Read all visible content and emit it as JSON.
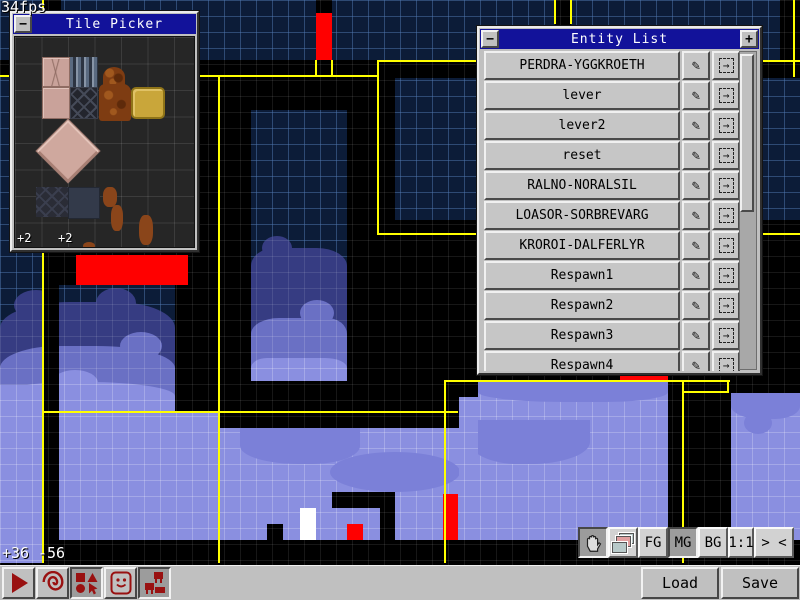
{
  "hud": {
    "fps": "34fps",
    "coord_x": "+36",
    "coord_y": "-56"
  },
  "colors": {
    "titlebar": "#12129a",
    "navy": "#0c1c38",
    "purple": "#8a8fe0",
    "red": "#ff0000",
    "yellow": "#ffff00",
    "iconred": "#991111",
    "silver": "#c0c0c0"
  },
  "icons": {
    "minimize": "−",
    "add": "+",
    "pencil": "✎",
    "goto": "→",
    "toolbar_tools": [
      "play",
      "spiral",
      "shapes",
      "face",
      "tiles"
    ],
    "layer_tools": [
      "hand",
      "layers"
    ]
  },
  "tile_picker": {
    "title": "Tile Picker",
    "offset_left": "+2",
    "offset_right": "+2",
    "tiles": [
      {
        "x": 27,
        "y": 20,
        "w": 28,
        "h": 30,
        "c": "t-pinkc"
      },
      {
        "x": 55,
        "y": 20,
        "w": 28,
        "h": 30,
        "c": "t-stripe"
      },
      {
        "x": 27,
        "y": 50,
        "w": 28,
        "h": 32,
        "c": "t-pink"
      },
      {
        "x": 55,
        "y": 50,
        "w": 28,
        "h": 32,
        "c": "t-lat"
      },
      {
        "x": 88,
        "y": 30,
        "w": 22,
        "h": 20,
        "c": "t-rock",
        "r": "50% 50% 0 0"
      },
      {
        "x": 84,
        "y": 47,
        "w": 32,
        "h": 37,
        "c": "t-rock"
      },
      {
        "x": 116,
        "y": 50,
        "w": 34,
        "h": 32,
        "c": "t-gold",
        "r": "5px"
      },
      {
        "x": 30,
        "y": 91,
        "w": 46,
        "h": 46,
        "c": "t-diamond",
        "rot": 45
      },
      {
        "x": 21,
        "y": 150,
        "w": 32,
        "h": 30,
        "c": "t-latf"
      },
      {
        "x": 53,
        "y": 150,
        "w": 32,
        "h": 32,
        "c": "t-slab"
      },
      {
        "x": 88,
        "y": 150,
        "w": 14,
        "h": 20,
        "c": "t-rockbit",
        "r": "40%"
      },
      {
        "x": 96,
        "y": 168,
        "w": 12,
        "h": 26,
        "c": "t-rockbit",
        "r": "40%"
      },
      {
        "x": 124,
        "y": 178,
        "w": 14,
        "h": 30,
        "c": "t-rockbit",
        "r": "40%"
      },
      {
        "x": 68,
        "y": 205,
        "w": 12,
        "h": 8,
        "c": "t-rockbit",
        "r": "50%"
      }
    ]
  },
  "entity_list": {
    "title": "Entity List",
    "entities": [
      "PERDRA-YGGKROETH",
      "lever",
      "lever2",
      "reset",
      "RALNO-NORALSIL",
      "LOASOR-SORBREVARG",
      "KROROI-DALFERLYR",
      "Respawn1",
      "Respawn2",
      "Respawn3",
      "Respawn4"
    ]
  },
  "layer_bar": {
    "fg": "FG",
    "mg": "MG",
    "bg": "BG",
    "zoom": "1:1",
    "shrink": "> <"
  },
  "toolbar": {
    "load_label": "Load",
    "save_label": "Save"
  },
  "canvas": {
    "rects": [
      {
        "x": 0,
        "y": 0,
        "w": 800,
        "h": 60,
        "c": "navy"
      },
      {
        "x": 43,
        "y": 0,
        "w": 18,
        "h": 11,
        "c": "black"
      },
      {
        "x": 555,
        "y": 0,
        "w": 16,
        "h": 60,
        "c": "black"
      },
      {
        "x": 780,
        "y": 0,
        "w": 20,
        "h": 77,
        "c": "black"
      },
      {
        "x": 316,
        "y": 0,
        "w": 16,
        "h": 13,
        "c": "black"
      },
      {
        "x": 316,
        "y": 13,
        "w": 16,
        "h": 47,
        "c": "red"
      },
      {
        "x": 0,
        "y": 60,
        "w": 800,
        "h": 17,
        "c": "black"
      },
      {
        "x": 175,
        "y": 77,
        "w": 625,
        "h": 336,
        "c": "black"
      },
      {
        "x": 0,
        "y": 77,
        "w": 175,
        "h": 175,
        "c": "navy"
      },
      {
        "x": 395,
        "y": 78,
        "w": 405,
        "h": 142,
        "c": "navy"
      },
      {
        "x": 251,
        "y": 110,
        "w": 96,
        "h": 271,
        "c": "navy"
      },
      {
        "x": 262,
        "y": 236,
        "w": 30,
        "h": 24,
        "c": "cloudDark",
        "r": "50%"
      },
      {
        "x": 251,
        "y": 248,
        "w": 96,
        "h": 133,
        "c": "cloudDark",
        "r": "24px 30px 0 0/18px"
      },
      {
        "x": 300,
        "y": 300,
        "w": 34,
        "h": 26,
        "c": "cloudMid",
        "r": "50%"
      },
      {
        "x": 251,
        "y": 318,
        "w": 96,
        "h": 63,
        "c": "cloudMid",
        "r": "28px 20px 0 0/16px"
      },
      {
        "x": 251,
        "y": 358,
        "w": 96,
        "h": 23,
        "c": "purple",
        "r": "16px 22px 0 0/10px"
      },
      {
        "x": 44,
        "y": 252,
        "w": 174,
        "h": 33,
        "c": "black"
      },
      {
        "x": 0,
        "y": 252,
        "w": 43,
        "h": 33,
        "c": "navy"
      },
      {
        "x": 76,
        "y": 255,
        "w": 112,
        "h": 30,
        "c": "red"
      },
      {
        "x": 0,
        "y": 285,
        "w": 175,
        "h": 128,
        "c": "navy"
      },
      {
        "x": 175,
        "y": 285,
        "w": 43,
        "h": 128,
        "c": "black"
      },
      {
        "x": 14,
        "y": 290,
        "w": 44,
        "h": 30,
        "c": "cloudDark",
        "r": "50%"
      },
      {
        "x": 96,
        "y": 288,
        "w": 40,
        "h": 30,
        "c": "cloudDark",
        "r": "50%"
      },
      {
        "x": 0,
        "y": 302,
        "w": 175,
        "h": 111,
        "c": "cloudDark",
        "r": "40% 34% 0 0/26px"
      },
      {
        "x": 120,
        "y": 332,
        "w": 42,
        "h": 28,
        "c": "cloudMid",
        "r": "50%"
      },
      {
        "x": 0,
        "y": 346,
        "w": 175,
        "h": 67,
        "c": "cloudMid",
        "r": "34% 45% 0 0/22px"
      },
      {
        "x": 52,
        "y": 370,
        "w": 46,
        "h": 26,
        "c": "purple",
        "r": "50%"
      },
      {
        "x": 0,
        "y": 382,
        "w": 175,
        "h": 31,
        "c": "purple",
        "r": "40% 50% 0 0/14px"
      },
      {
        "x": 0,
        "y": 385,
        "w": 43,
        "h": 178,
        "c": "purple"
      },
      {
        "x": 59,
        "y": 413,
        "w": 741,
        "h": 127,
        "c": "purple"
      },
      {
        "x": 219,
        "y": 413,
        "w": 241,
        "h": 15,
        "c": "black"
      },
      {
        "x": 240,
        "y": 428,
        "w": 120,
        "h": 36,
        "c": "purpleShade",
        "r": "0 0 45% 55%/20px"
      },
      {
        "x": 330,
        "y": 452,
        "w": 130,
        "h": 40,
        "c": "purpleShade",
        "r": "50%"
      },
      {
        "x": 470,
        "y": 420,
        "w": 120,
        "h": 44,
        "c": "purpleShade",
        "r": "0 0 50% 40%/22px"
      },
      {
        "x": 478,
        "y": 382,
        "w": 190,
        "h": 32,
        "c": "purple"
      },
      {
        "x": 478,
        "y": 382,
        "w": 190,
        "h": 20,
        "c": "purpleShade",
        "r": "0 0 40% 55%/12px"
      },
      {
        "x": 459,
        "y": 397,
        "w": 19,
        "h": 143,
        "c": "purple"
      },
      {
        "x": 668,
        "y": 380,
        "w": 63,
        "h": 160,
        "c": "black"
      },
      {
        "x": 620,
        "y": 375,
        "w": 48,
        "h": 6,
        "c": "red"
      },
      {
        "x": 731,
        "y": 393,
        "w": 69,
        "h": 147,
        "c": "purple"
      },
      {
        "x": 731,
        "y": 393,
        "w": 69,
        "h": 26,
        "c": "purpleShade",
        "r": "0 0 45% 55%/16px"
      },
      {
        "x": 744,
        "y": 412,
        "w": 28,
        "h": 22,
        "c": "purpleShade",
        "r": "50%"
      },
      {
        "x": 44,
        "y": 285,
        "w": 15,
        "h": 278,
        "c": "black"
      },
      {
        "x": 332,
        "y": 492,
        "w": 63,
        "h": 16,
        "c": "black"
      },
      {
        "x": 380,
        "y": 508,
        "w": 15,
        "h": 32,
        "c": "black"
      },
      {
        "x": 267,
        "y": 524,
        "w": 16,
        "h": 16,
        "c": "black"
      },
      {
        "x": 300,
        "y": 508,
        "w": 16,
        "h": 32,
        "c": "white"
      },
      {
        "x": 347,
        "y": 524,
        "w": 16,
        "h": 16,
        "c": "red"
      },
      {
        "x": 443,
        "y": 494,
        "w": 15,
        "h": 46,
        "c": "red"
      },
      {
        "x": 44,
        "y": 540,
        "w": 756,
        "h": 23,
        "c": "black"
      },
      {
        "x": 0,
        "y": 540,
        "w": 43,
        "h": 23,
        "c": "purple"
      },
      {
        "x": 0,
        "y": 563,
        "w": 800,
        "h": 2,
        "c": "black"
      },
      {
        "x": 554,
        "y": 0,
        "w": 2,
        "h": 24,
        "c": "yellow"
      },
      {
        "x": 570,
        "y": 0,
        "w": 2,
        "h": 24,
        "c": "yellow"
      },
      {
        "x": 793,
        "y": 0,
        "w": 2,
        "h": 77,
        "c": "yellow"
      },
      {
        "x": 0,
        "y": 75,
        "w": 316,
        "h": 2,
        "c": "yellow"
      },
      {
        "x": 315,
        "y": 60,
        "w": 2,
        "h": 17,
        "c": "yellow"
      },
      {
        "x": 331,
        "y": 60,
        "w": 2,
        "h": 17,
        "c": "yellow"
      },
      {
        "x": 315,
        "y": 75,
        "w": 18,
        "h": 2,
        "c": "yellow"
      },
      {
        "x": 333,
        "y": 75,
        "w": 46,
        "h": 2,
        "c": "yellow"
      },
      {
        "x": 377,
        "y": 60,
        "w": 423,
        "h": 2,
        "c": "yellow"
      },
      {
        "x": 377,
        "y": 60,
        "w": 2,
        "h": 175,
        "c": "yellow"
      },
      {
        "x": 377,
        "y": 233,
        "w": 423,
        "h": 2,
        "c": "yellow"
      },
      {
        "x": 42,
        "y": 0,
        "w": 2,
        "h": 563,
        "c": "yellow"
      },
      {
        "x": 218,
        "y": 77,
        "w": 2,
        "h": 486,
        "c": "yellow"
      },
      {
        "x": 42,
        "y": 411,
        "w": 416,
        "h": 2,
        "c": "yellow"
      },
      {
        "x": 444,
        "y": 380,
        "w": 2,
        "h": 183,
        "c": "yellow"
      },
      {
        "x": 444,
        "y": 380,
        "w": 36,
        "h": 2,
        "c": "yellow"
      },
      {
        "x": 478,
        "y": 380,
        "w": 252,
        "h": 2,
        "c": "yellow"
      },
      {
        "x": 682,
        "y": 380,
        "w": 2,
        "h": 183,
        "c": "yellow"
      },
      {
        "x": 727,
        "y": 380,
        "w": 2,
        "h": 13,
        "c": "yellow"
      },
      {
        "x": 682,
        "y": 391,
        "w": 47,
        "h": 2,
        "c": "yellow"
      }
    ]
  }
}
